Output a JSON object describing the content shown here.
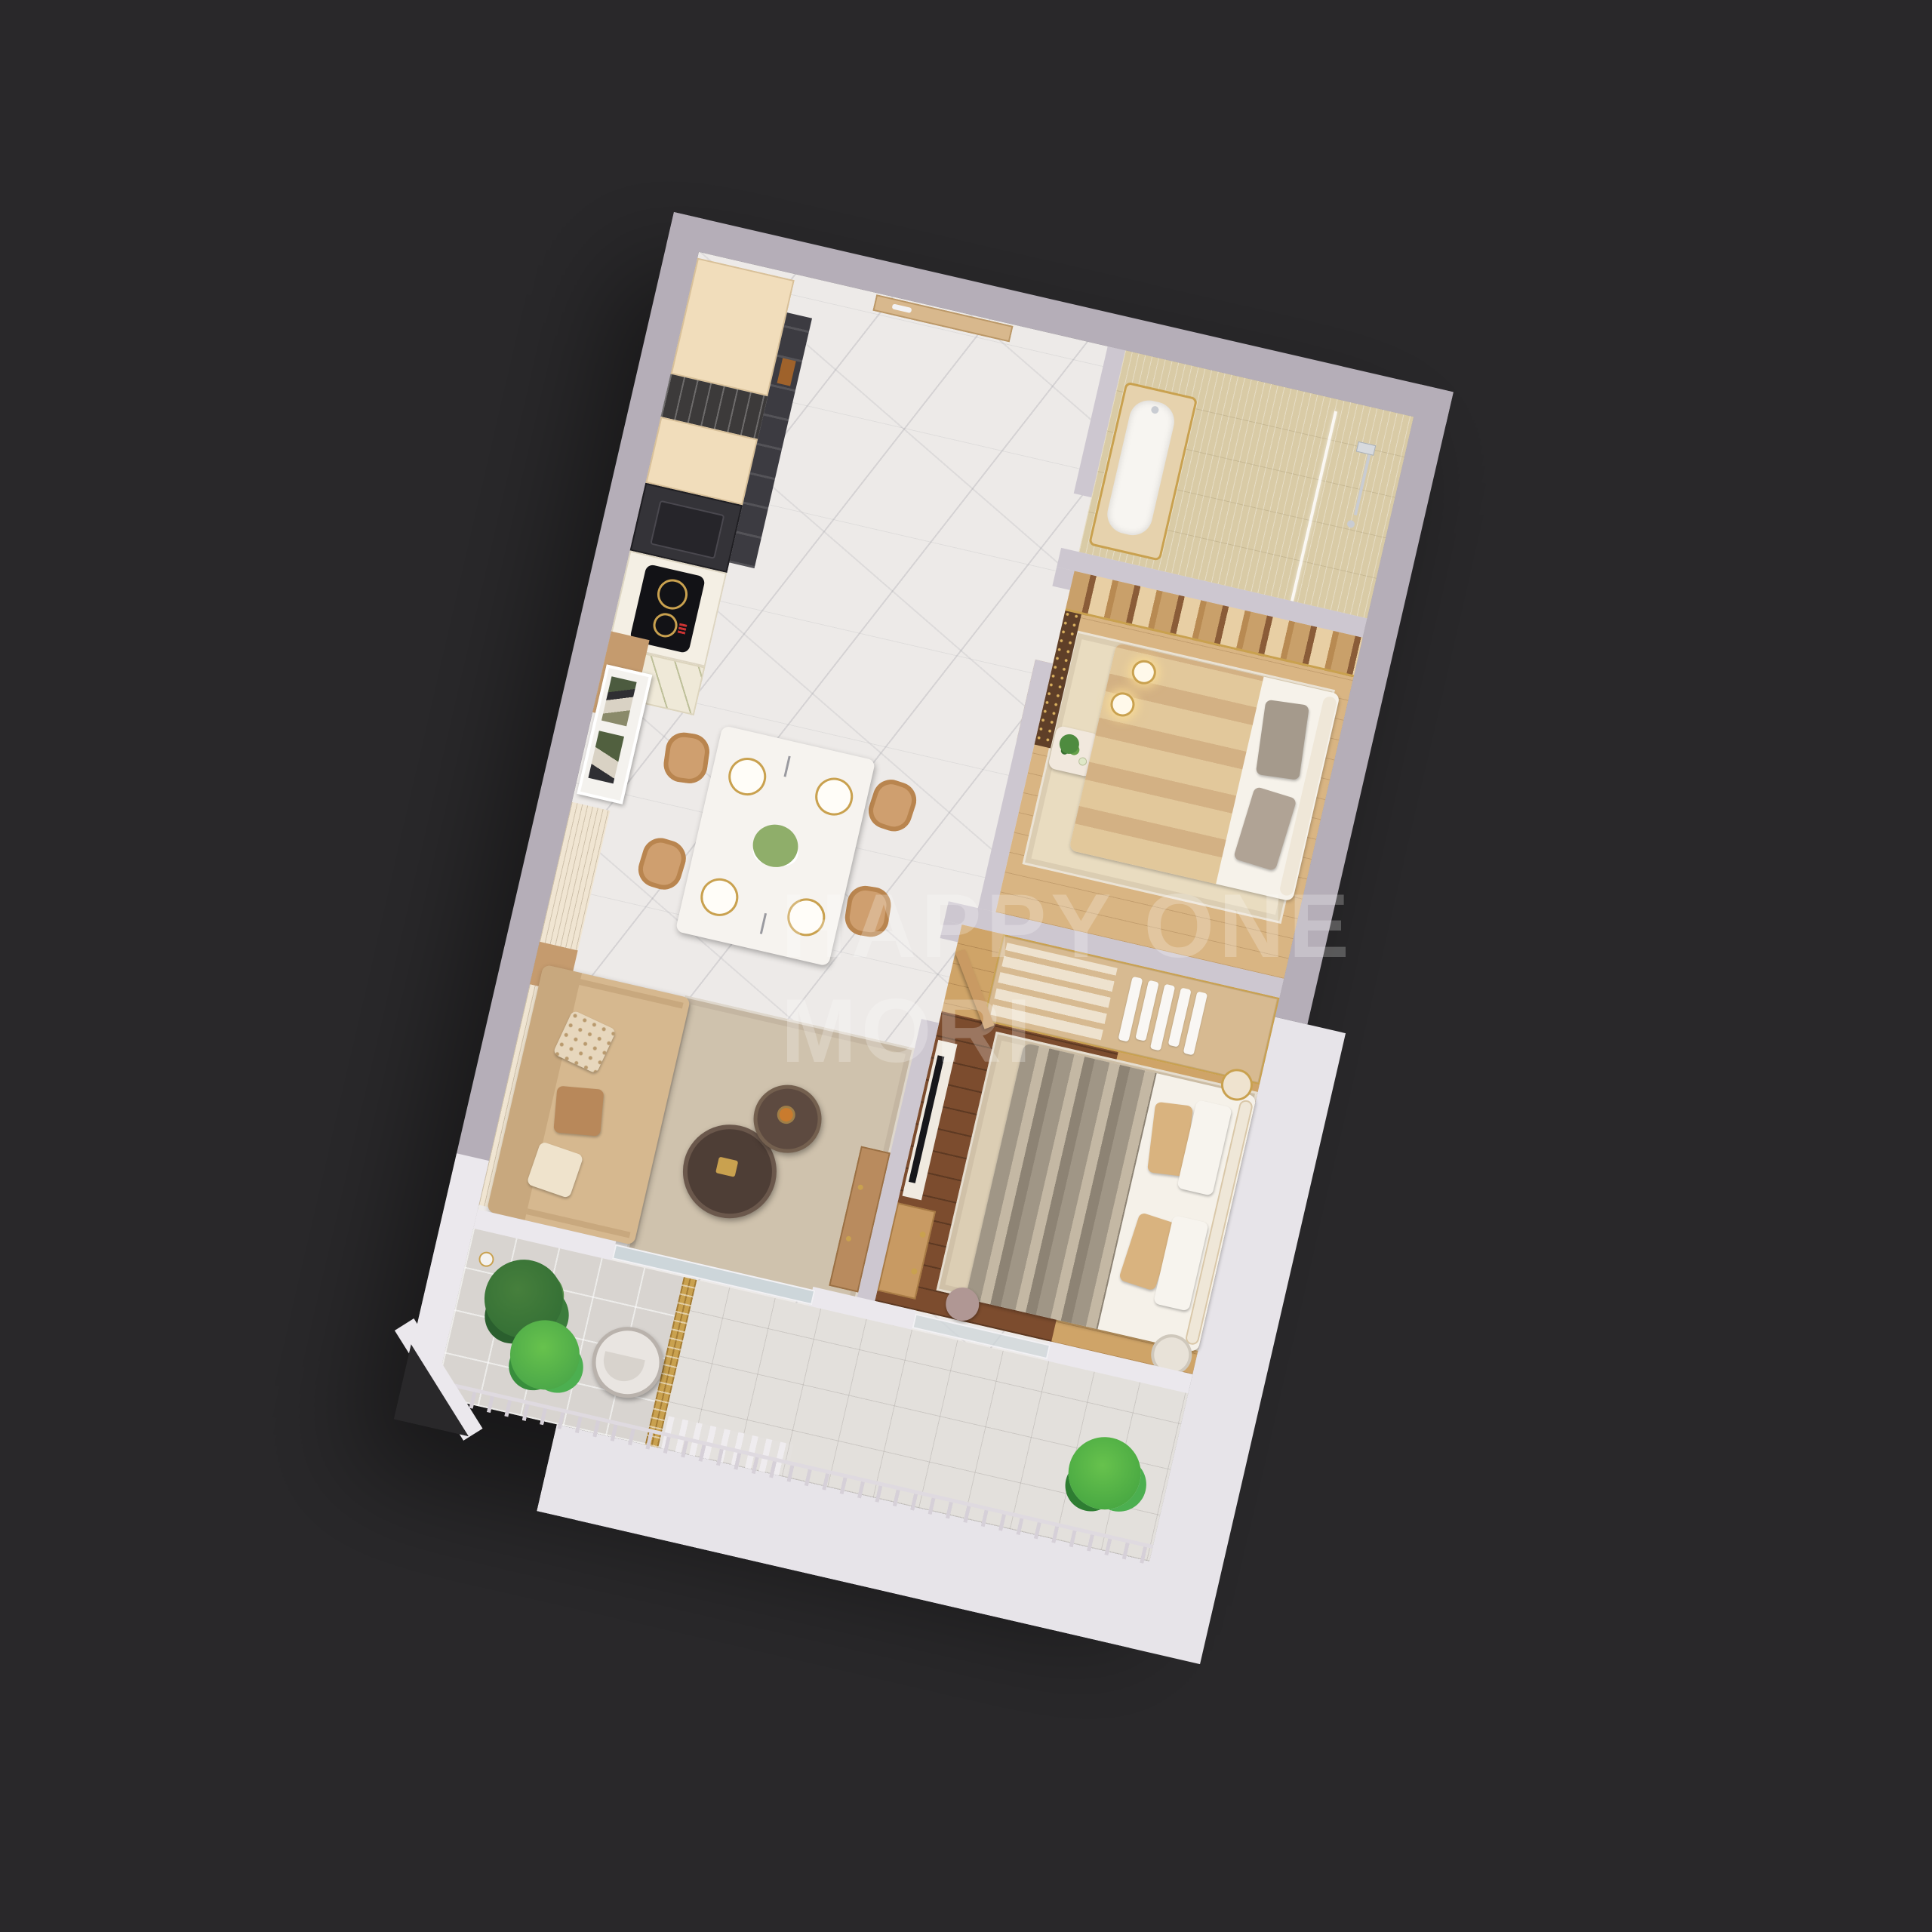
{
  "scene": {
    "description": "3D isometric render of a one-level apartment floor plan on a dark background",
    "view": "top-down isometric, plan rotated clockwise",
    "background_color": "#29282a"
  },
  "watermark": {
    "line1": "HAPPY ONE",
    "line2": "MORI"
  },
  "palette": {
    "background": "#29282a",
    "outer_wall_band": "#b5aeb8",
    "white_platform": "#e7e4e9",
    "inner_wall": "#cdc7d0",
    "marble_floor": "#edeae8",
    "bath_tile": "#d9cba6",
    "oak_floor": "#d9b583",
    "oak_floor_light": "#cfa468",
    "walnut_floor": "#7c4c2e",
    "balcony_tile": "#d8d4d0",
    "balcony_tile_light": "#e3e0dc",
    "cabinet_cream": "#f1ddbb",
    "appliance_dark": "#3c3b41",
    "counter_dark": "#343338",
    "wood_door": "#d8b88d",
    "sofa_tan": "#d6b88f",
    "chair_tan": "#cf9f6f",
    "table_white": "#f6f3ef",
    "gold_accent": "#c9a14f",
    "plant_dark_green": "#2f6b33",
    "plant_bright_green": "#43a047",
    "bed_white": "#f5f1e9",
    "throw_gray": "#a09686",
    "pillow_tan": "#d9b37f",
    "headboard_cream": "#efe7d8",
    "tv_black": "#17171b",
    "glass_blue": "#cdd6da"
  },
  "rooms": [
    {
      "name": "kitchen",
      "furniture": [
        "cream cabinet run",
        "dark oven tower",
        "fridge",
        "black sink counter",
        "induction cooktop",
        "marble counter"
      ]
    },
    {
      "name": "entry-hall",
      "furniture": [
        "entry door",
        "marble tile floor"
      ]
    },
    {
      "name": "bathroom",
      "furniture": [
        "bathtub with gold trim",
        "glass shower screen",
        "chrome shower set"
      ]
    },
    {
      "name": "bedroom-1",
      "furniture": [
        "double bed",
        "gray pillows",
        "striped feature wall",
        "two pendant lights",
        "gold dot screen",
        "console with plant"
      ]
    },
    {
      "name": "bedroom-2",
      "furniture": [
        "double bed with striped throw",
        "wardrobe with hanging clothes",
        "TV panel",
        "wood dresser",
        "bedside lamp",
        "foot stool"
      ]
    },
    {
      "name": "dining-area",
      "furniture": [
        "marble dining table",
        "4 tan chairs",
        "4 gold place settings",
        "flower centerpiece",
        "wall art"
      ]
    },
    {
      "name": "living-area",
      "furniture": [
        "tan sofa with cushions",
        "two round coffee tables",
        "area rug",
        "media console"
      ]
    },
    {
      "name": "balcony-left",
      "furniture": [
        "two green plants",
        "round lounge chair",
        "wall sconce",
        "gold lattice divider"
      ]
    },
    {
      "name": "balcony-bottom",
      "furniture": [
        "green plant",
        "railing with balusters",
        "white slat fence",
        "sliding glass doors"
      ]
    }
  ]
}
